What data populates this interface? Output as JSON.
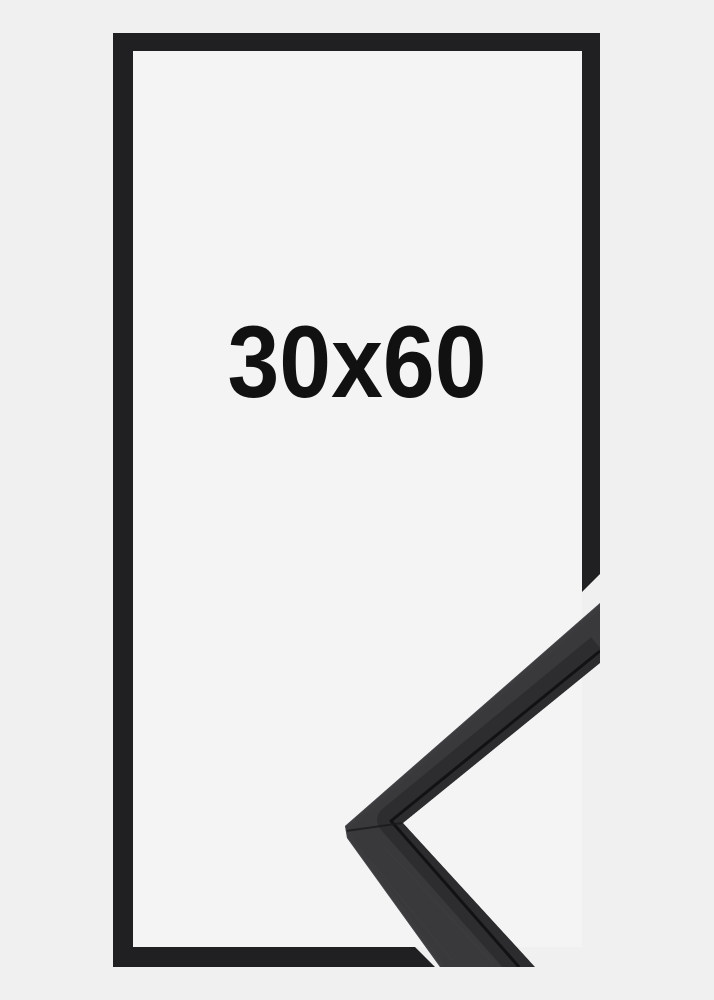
{
  "product": {
    "size_label": "30x60"
  },
  "colors": {
    "background": "#f0f0f1",
    "inside_background": "#f4f4f5",
    "frame_black": "#202022",
    "moulding_face": "#39393b",
    "moulding_lip": "#2c2c2e",
    "label_text": "#111111"
  }
}
